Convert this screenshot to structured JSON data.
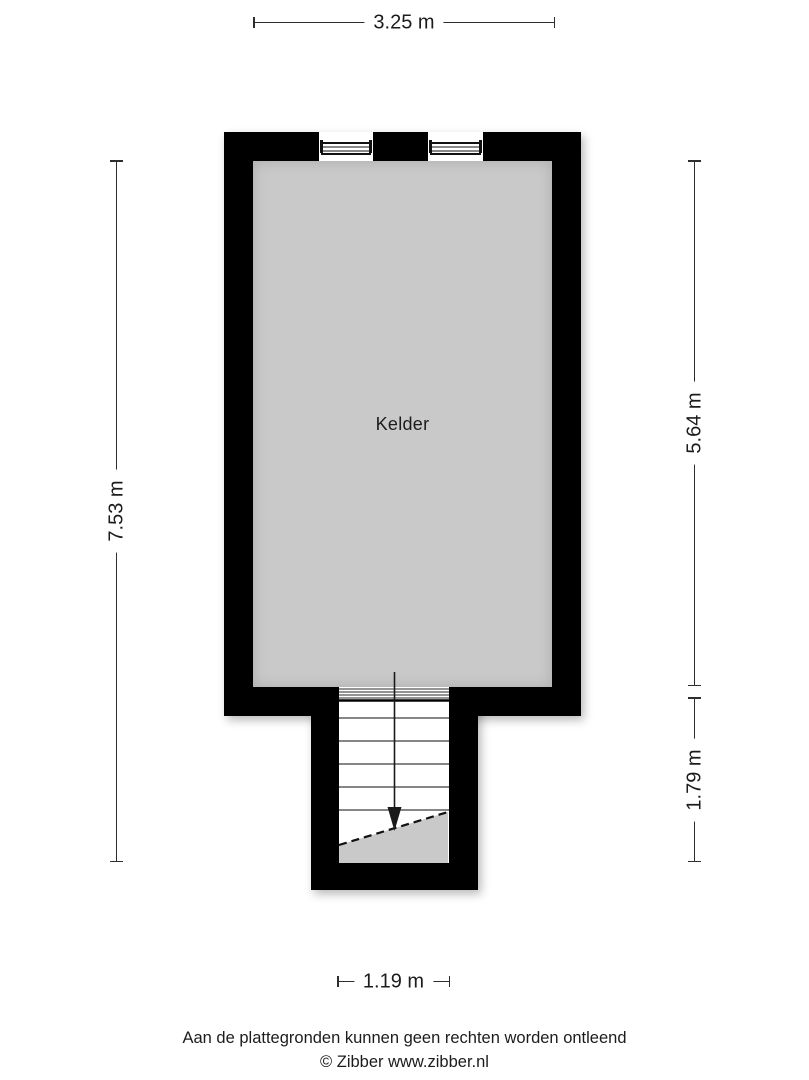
{
  "plan": {
    "room_label": "Kelder",
    "dimensions": {
      "top": "3.25 m",
      "left": "7.53 m",
      "right_upper": "5.64 m",
      "right_lower": "1.79 m",
      "bottom": "1.19 m"
    },
    "colors": {
      "wall": "#000000",
      "floor": "#c9c9c9",
      "dimension_line": "#2e2e2e",
      "text": "#1c1c1c",
      "background": "#ffffff"
    },
    "icons": {
      "windows": 2,
      "stair_arrow": "down-arrow"
    }
  },
  "footer": {
    "disclaimer": "Aan de plattegronden kunnen geen rechten worden ontleend",
    "copyright": "© Zibber www.zibber.nl"
  }
}
